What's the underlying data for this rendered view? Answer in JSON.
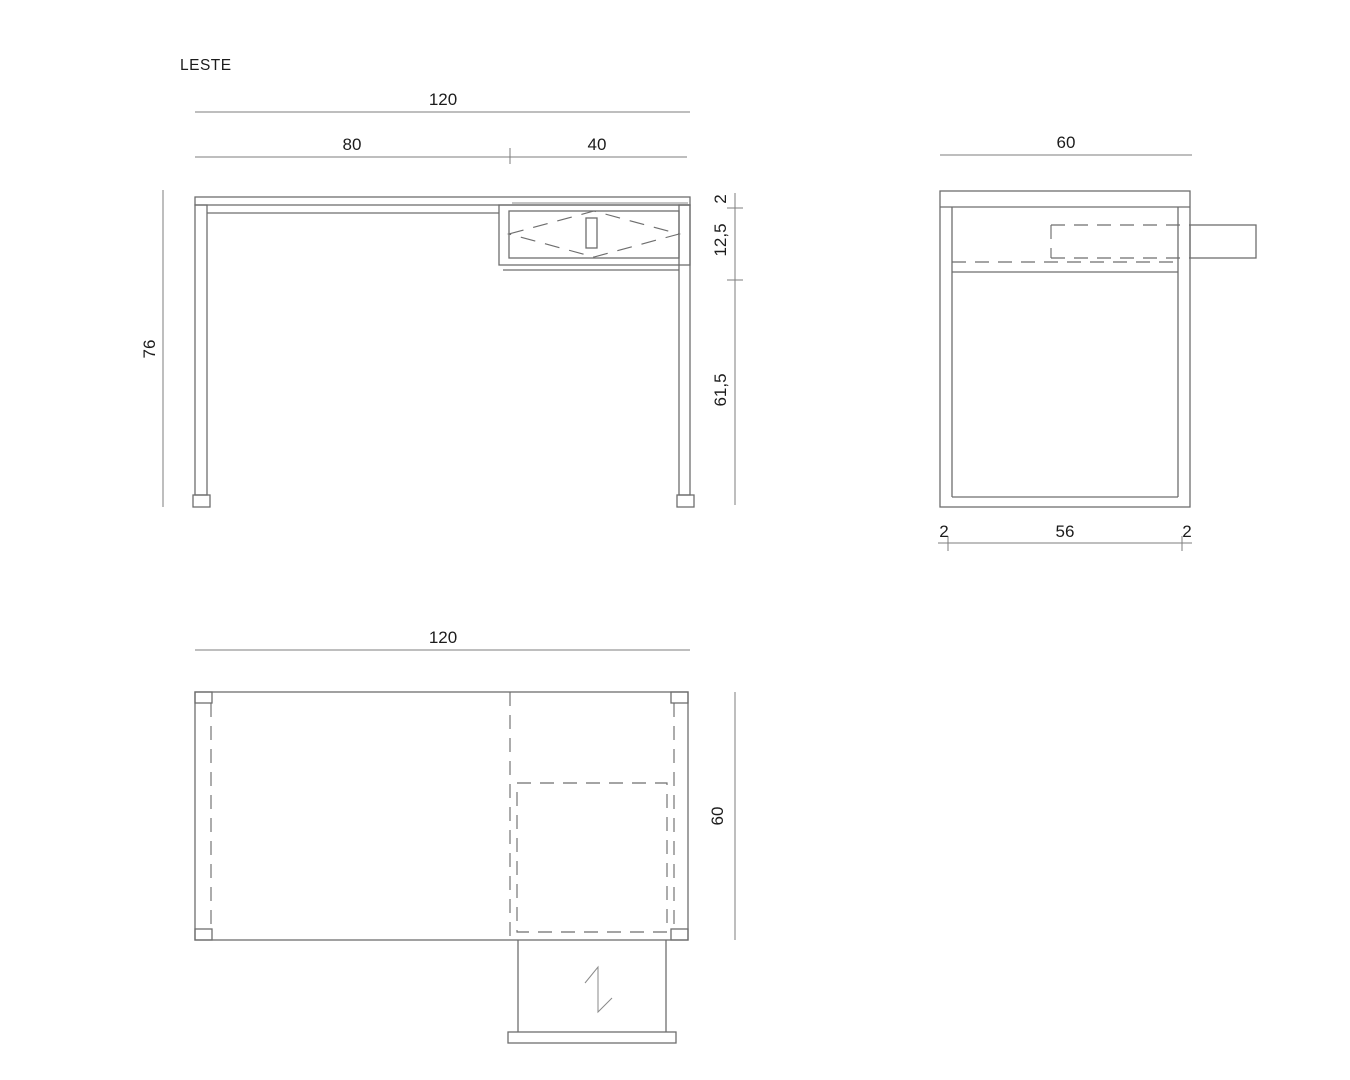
{
  "drawing": {
    "title": "LESTE",
    "line_color": "#6e6e6e",
    "text_color": "#1c1c1c",
    "views": {
      "front": {
        "dim_total_width": "120",
        "dim_left_section": "80",
        "dim_right_section": "40",
        "dim_height": "76",
        "dim_top_thickness": "2",
        "dim_drawer_band": "12,5",
        "dim_under_drawer": "61,5"
      },
      "side": {
        "dim_depth": "60",
        "dim_panel_left": "2",
        "dim_interior": "56",
        "dim_panel_right": "2"
      },
      "plan": {
        "dim_width": "120",
        "dim_depth": "60"
      }
    }
  }
}
